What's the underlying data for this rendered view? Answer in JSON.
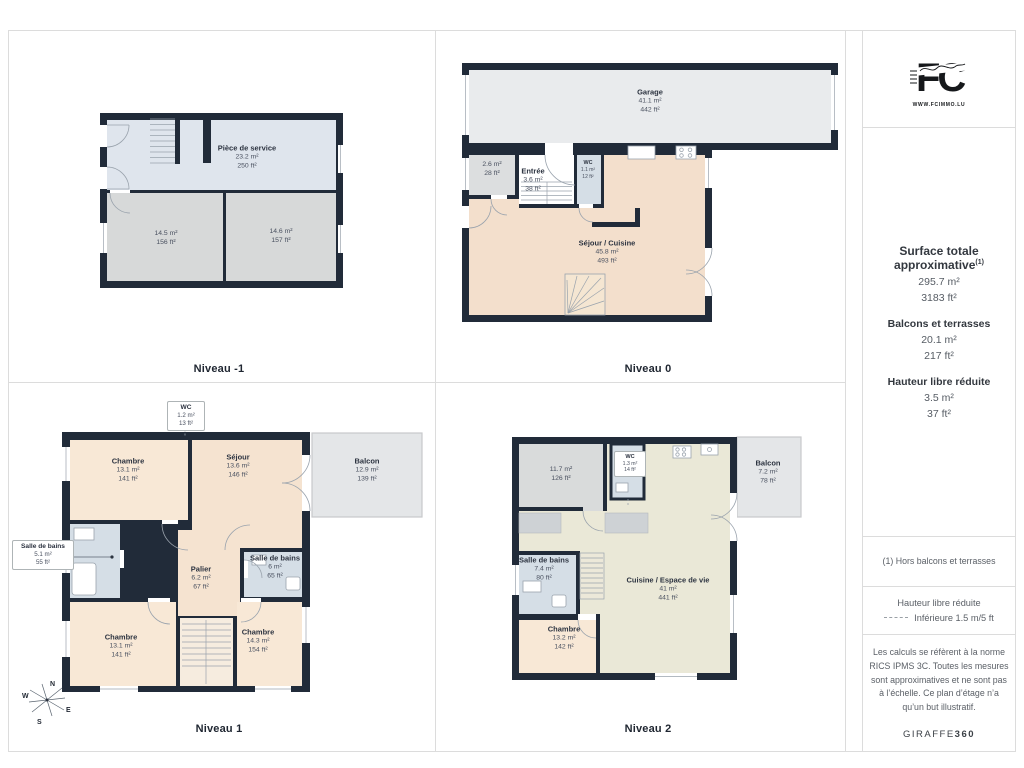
{
  "levels": [
    {
      "label": "Niveau -1",
      "rooms": [
        {
          "name": "Pièce de service",
          "m2": "23.2 m²",
          "ft2": "250 ft²"
        },
        {
          "name": "",
          "m2": "14.5 m²",
          "ft2": "156 ft²"
        },
        {
          "name": "",
          "m2": "14.6 m²",
          "ft2": "157 ft²"
        }
      ]
    },
    {
      "label": "Niveau 0",
      "rooms": [
        {
          "name": "Garage",
          "m2": "41.1 m²",
          "ft2": "442 ft²"
        },
        {
          "name": "",
          "m2": "2.6 m²",
          "ft2": "28 ft²"
        },
        {
          "name": "Entrée",
          "m2": "3.6 m²",
          "ft2": "38 ft²"
        },
        {
          "name": "WC",
          "m2": "1.1 m²",
          "ft2": "12 ft²"
        },
        {
          "name": "Séjour / Cuisine",
          "m2": "45.8 m²",
          "ft2": "493 ft²"
        }
      ]
    },
    {
      "label": "Niveau 1",
      "rooms": [
        {
          "name": "WC",
          "m2": "1.2 m²",
          "ft2": "13 ft²"
        },
        {
          "name": "Chambre",
          "m2": "13.1 m²",
          "ft2": "141 ft²"
        },
        {
          "name": "Séjour",
          "m2": "13.6 m²",
          "ft2": "146 ft²"
        },
        {
          "name": "Balcon",
          "m2": "12.9 m²",
          "ft2": "139 ft²"
        },
        {
          "name": "Salle de bains",
          "m2": "5.1 m²",
          "ft2": "55 ft²"
        },
        {
          "name": "Palier",
          "m2": "6.2 m²",
          "ft2": "67 ft²"
        },
        {
          "name": "Salle de bains",
          "m2": "6 m²",
          "ft2": "65 ft²"
        },
        {
          "name": "Chambre",
          "m2": "13.1 m²",
          "ft2": "141 ft²"
        },
        {
          "name": "Chambre",
          "m2": "14.3 m²",
          "ft2": "154 ft²"
        }
      ]
    },
    {
      "label": "Niveau 2",
      "rooms": [
        {
          "name": "",
          "m2": "11.7 m²",
          "ft2": "126 ft²"
        },
        {
          "name": "WC",
          "m2": "1.3 m²",
          "ft2": "14 ft²"
        },
        {
          "name": "Balcon",
          "m2": "7.2 m²",
          "ft2": "78 ft²"
        },
        {
          "name": "Salle de bains",
          "m2": "7.4 m²",
          "ft2": "80 ft²"
        },
        {
          "name": "Cuisine / Espace de vie",
          "m2": "41 m²",
          "ft2": "441 ft²"
        },
        {
          "name": "Chambre",
          "m2": "13.2 m²",
          "ft2": "142 ft²"
        }
      ]
    }
  ],
  "sidebar": {
    "logo": {
      "monogram": "FC",
      "url": "WWW.FCIMMO.LU"
    },
    "totals": {
      "heading": "Surface totale approximative",
      "heading_sup": "(1)",
      "m2": "295.7 m²",
      "ft2": "3183 ft²",
      "balconies_heading": "Balcons et terrasses",
      "balconies_m2": "20.1 m²",
      "balconies_ft2": "217 ft²",
      "reduced_heading": "Hauteur libre réduite",
      "reduced_m2": "3.5 m²",
      "reduced_ft2": "37 ft²"
    },
    "footnote": "(1) Hors balcons et terrasses",
    "legend": {
      "heading": "Hauteur libre réduite",
      "text": "Inférieure 1.5 m/5 ft"
    },
    "disclaimer": "Les calculs se réfèrent à la norme RICS IPMS 3C. Toutes les mesures sont approximatives et ne sont pas à l’échelle. Ce plan d’étage n’a qu’un but illustratif.",
    "brand": {
      "name": "GIRAFFE",
      "bold": "360"
    }
  },
  "compass": {
    "n": "N",
    "e": "E",
    "s": "S",
    "w": "W"
  },
  "colors": {
    "wall": "#212b39",
    "service_room": "#dfe5ed",
    "gray_room": "#d7d9d9",
    "garage": "#e9ebed",
    "living_peach": "#f3dfcc",
    "bedroom_peach": "#f8e8d6",
    "bathroom": "#d5dee6",
    "kitchen_cream": "#eae8d7",
    "balcony": "#e4e6e8",
    "divider": "#dcdcdc"
  }
}
